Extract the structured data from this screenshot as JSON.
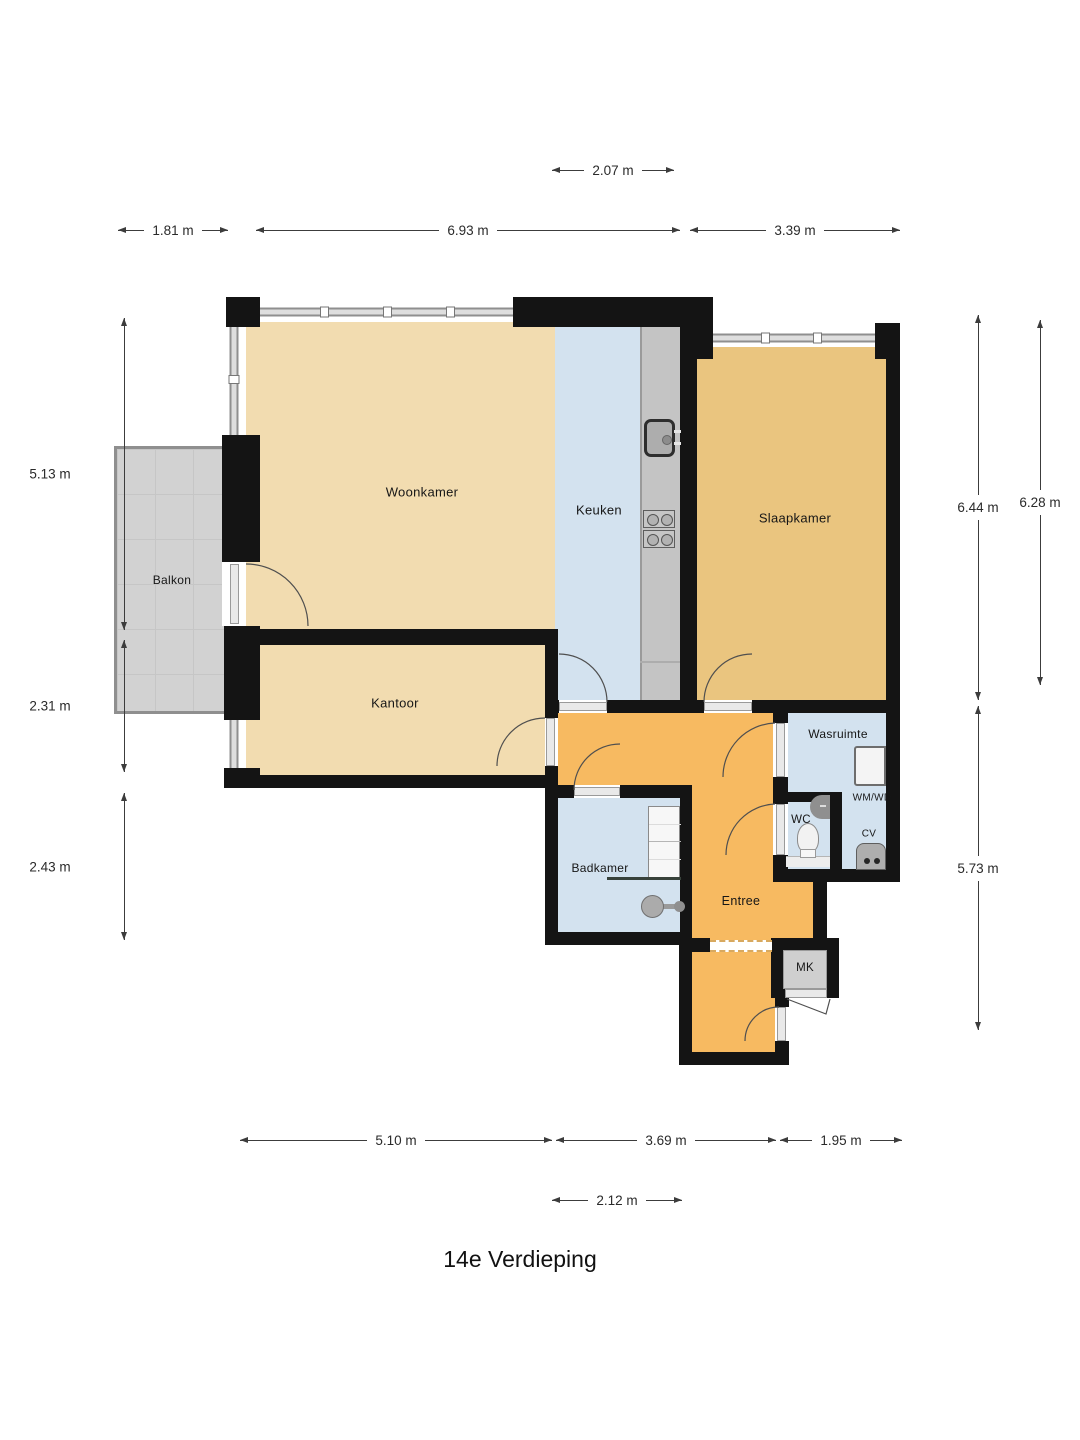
{
  "title": "14e Verdieping",
  "colors": {
    "wall": "#141414",
    "living": "#f2dcb0",
    "kitchen": "#d3e2ef",
    "bedroom": "#eac57f",
    "hall": "#f7ba61",
    "balcony": "#d2d2d2",
    "counter": "#c4c4c4",
    "dimension": "#2a2a2a"
  },
  "rooms": {
    "woonkamer": "Woonkamer",
    "keuken": "Keuken",
    "slaapkamer": "Slaapkamer",
    "kantoor": "Kantoor",
    "balkon": "Balkon",
    "wasruimte": "Wasruimte",
    "wc": "WC",
    "badkamer": "Badkamer",
    "entree": "Entree"
  },
  "fixtures": {
    "wm_wd": "WM/WD",
    "cv": "CV",
    "mk": "MK"
  },
  "dimensions": {
    "top_center": "2.07 m",
    "top_left": "1.81 m",
    "top_middle": "6.93 m",
    "top_right": "3.39 m",
    "left_upper": "5.13 m",
    "left_middle": "2.31 m",
    "left_lower": "2.43 m",
    "right_outer": "6.44 m",
    "right_inner": "6.28 m",
    "right_lower": "5.73 m",
    "bottom_left": "5.10 m",
    "bottom_middle": "3.69 m",
    "bottom_right": "1.95 m",
    "bottom_center": "2.12 m"
  }
}
